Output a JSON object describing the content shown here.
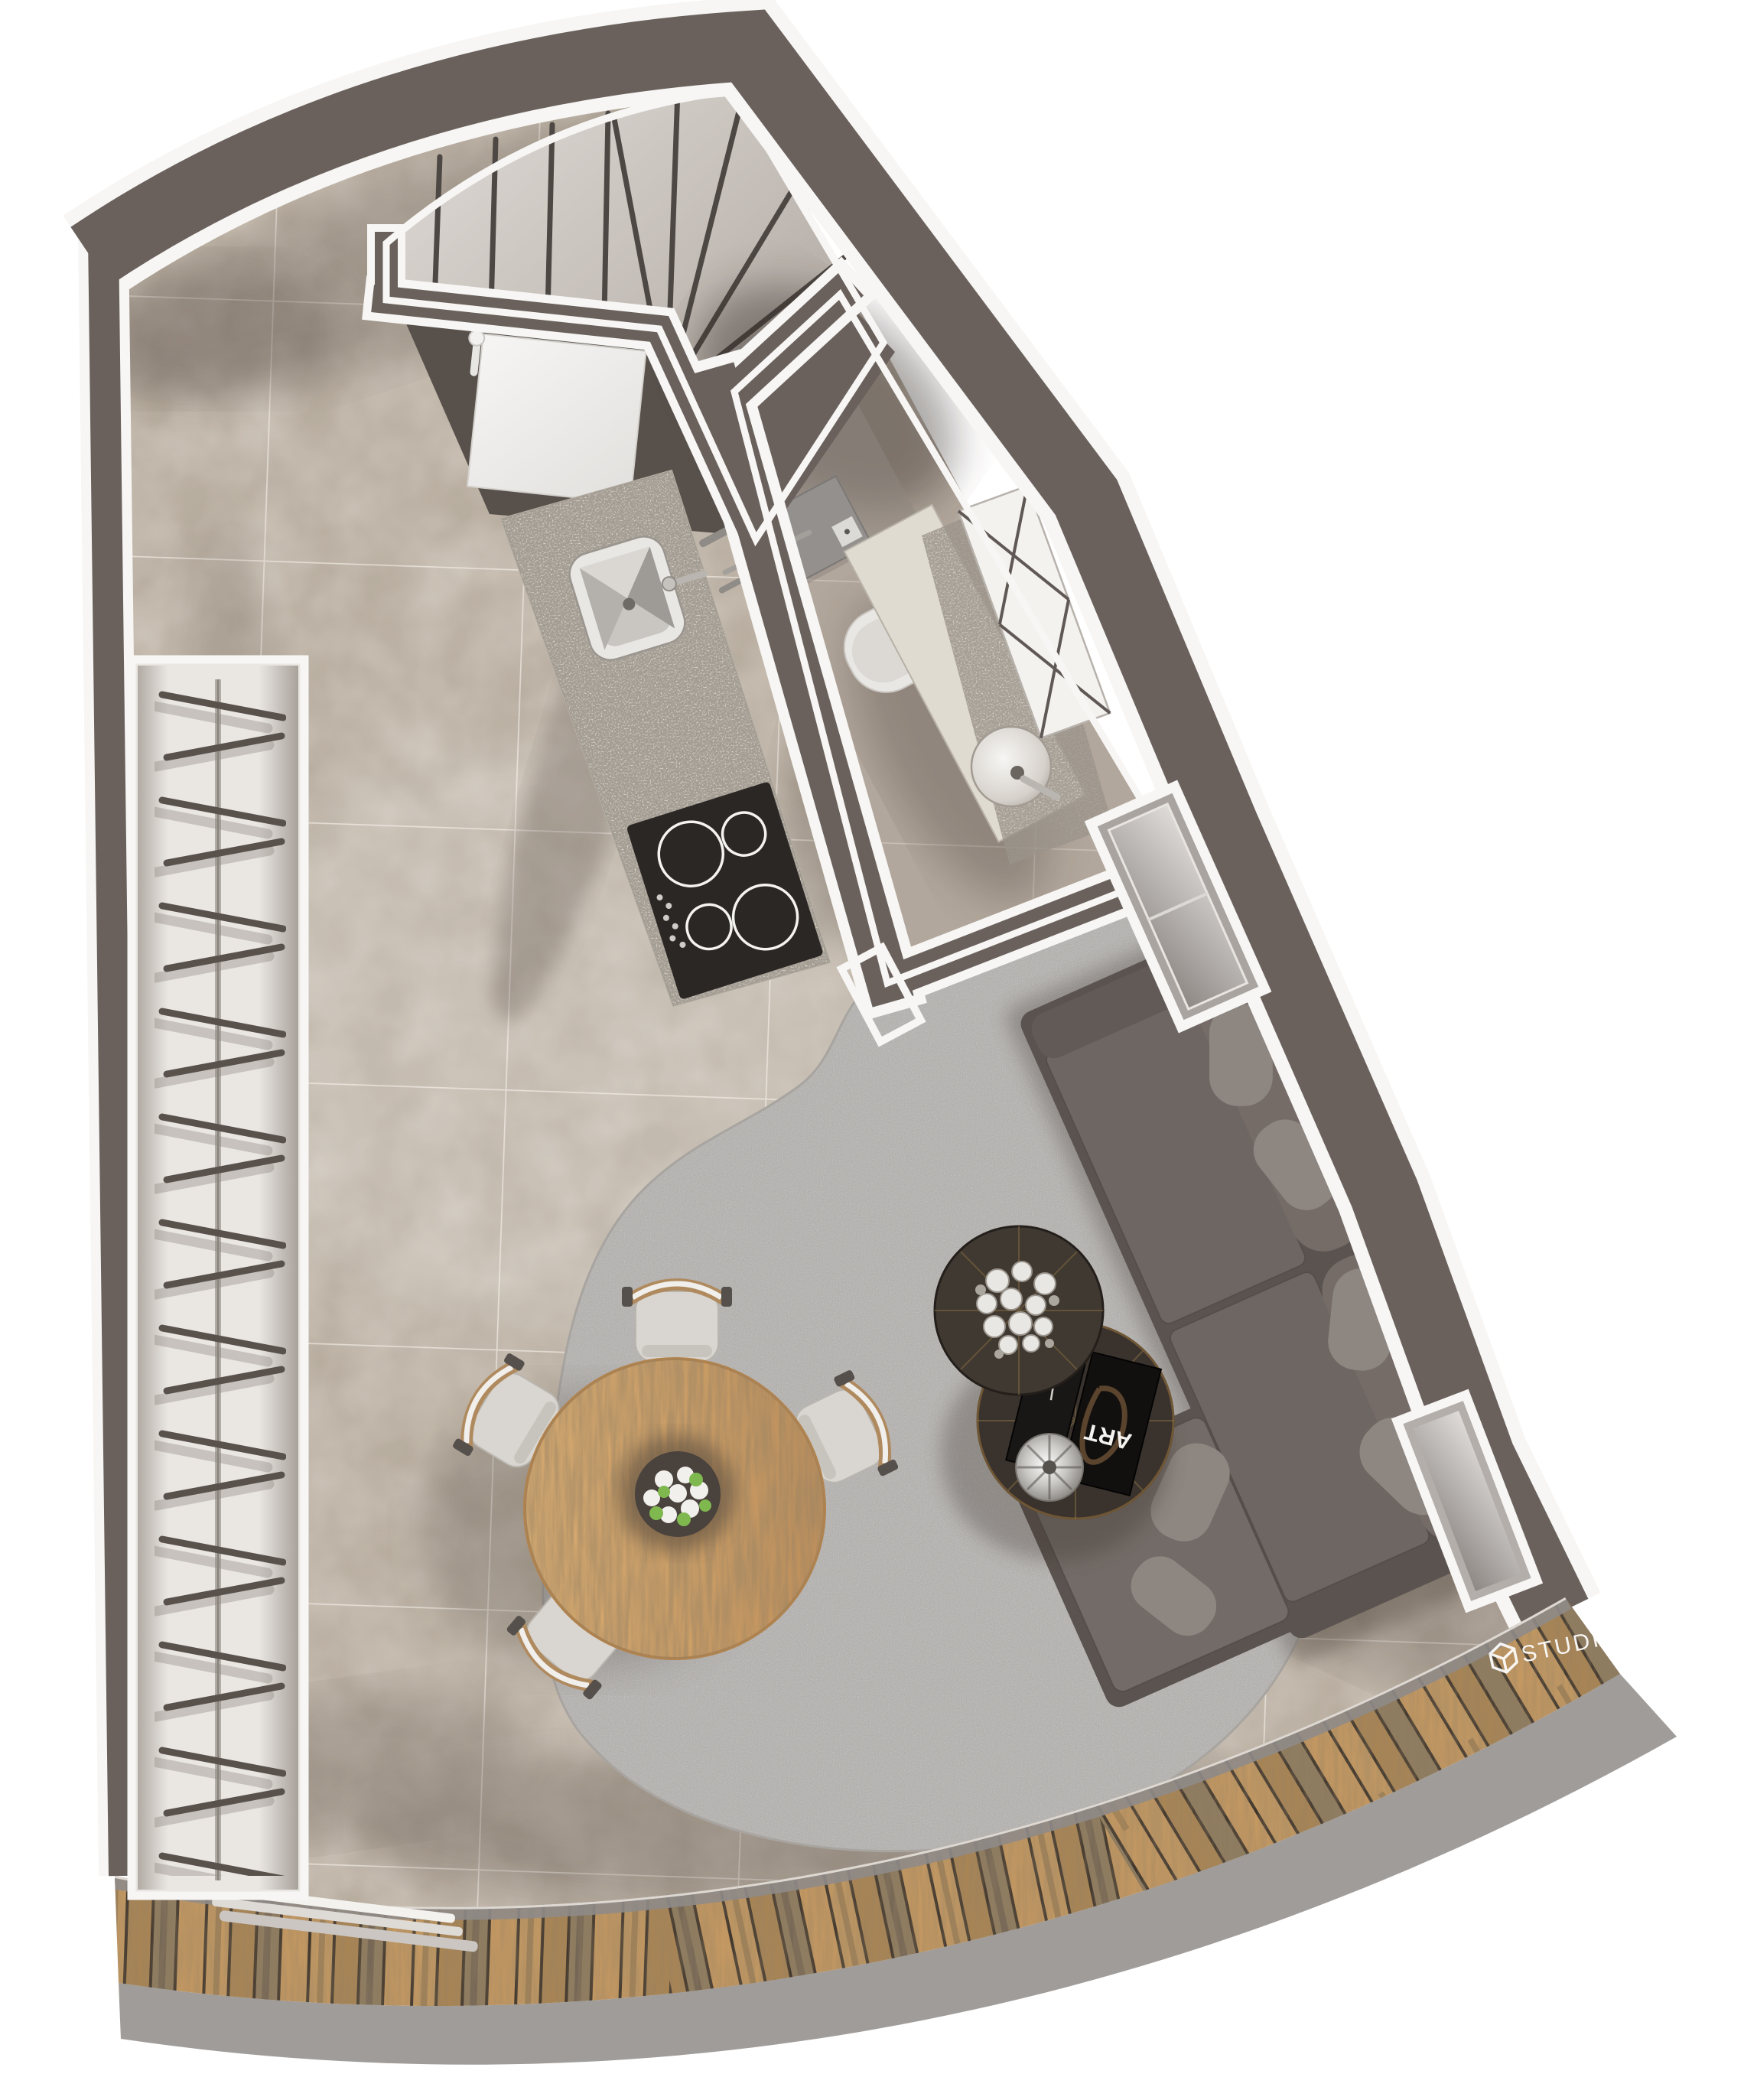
{
  "watermark": {
    "text": "STUDIO",
    "icon": "cube-logo-icon",
    "color": "#ffffff"
  },
  "coffee_table": {
    "book_title": "ART"
  },
  "plan": {
    "kind": "top-down 3d floor plan rendering",
    "rooms": [
      "staircase",
      "kitchen",
      "bathroom",
      "living-area",
      "dining-area",
      "wardrobe",
      "balcony-deck"
    ],
    "furniture": [
      "winder-staircase",
      "fridge",
      "kitchen-counter-with-sink",
      "induction-hob-4-burners",
      "shower",
      "toilet",
      "vanity-basin",
      "x-brace-cabinet",
      "glass-door",
      "sofa-with-chaise",
      "coffee-table-flowers",
      "coffee-table-books-bowl",
      "round-dining-table",
      "dining-chair",
      "wardrobe-rail-with-hangers",
      "sliding-glass-door",
      "wood-deck",
      "windows"
    ],
    "stairs": {
      "straight_treads": 4,
      "winder_treads": 8
    },
    "dining": {
      "chairs": 4
    }
  },
  "palette": {
    "wall": "#6a615c",
    "wall_dark": "#57504b",
    "floor_tile": "#cfc6bb",
    "bath_floor": "#b2a79c",
    "stair_tread_light": "#dcd8d4",
    "stair_tread_dark": "#a39a93",
    "counter_granite": "#e3ded4",
    "hob": "#2b2725",
    "rug": "#c9c6c3",
    "sofa": "#5b534f",
    "sofa_cushion": "#6e6662",
    "pillow": "#8d8681",
    "table_wood": "#d3a369",
    "chair_seat": "#d9d6d1",
    "chair_wood": "#b08a5f",
    "deck_wood": "#b98e58",
    "deck_gap": "#3c332a",
    "plinth": "#a09c99",
    "wardrobe": "#eae7e3",
    "hanger": "#59524c",
    "outline": "#f7f6f4",
    "toilet": "#e9e7e4",
    "flower": "#f2f0ed",
    "fruit_green": "#7fb84f",
    "logo": "#ffffff"
  }
}
